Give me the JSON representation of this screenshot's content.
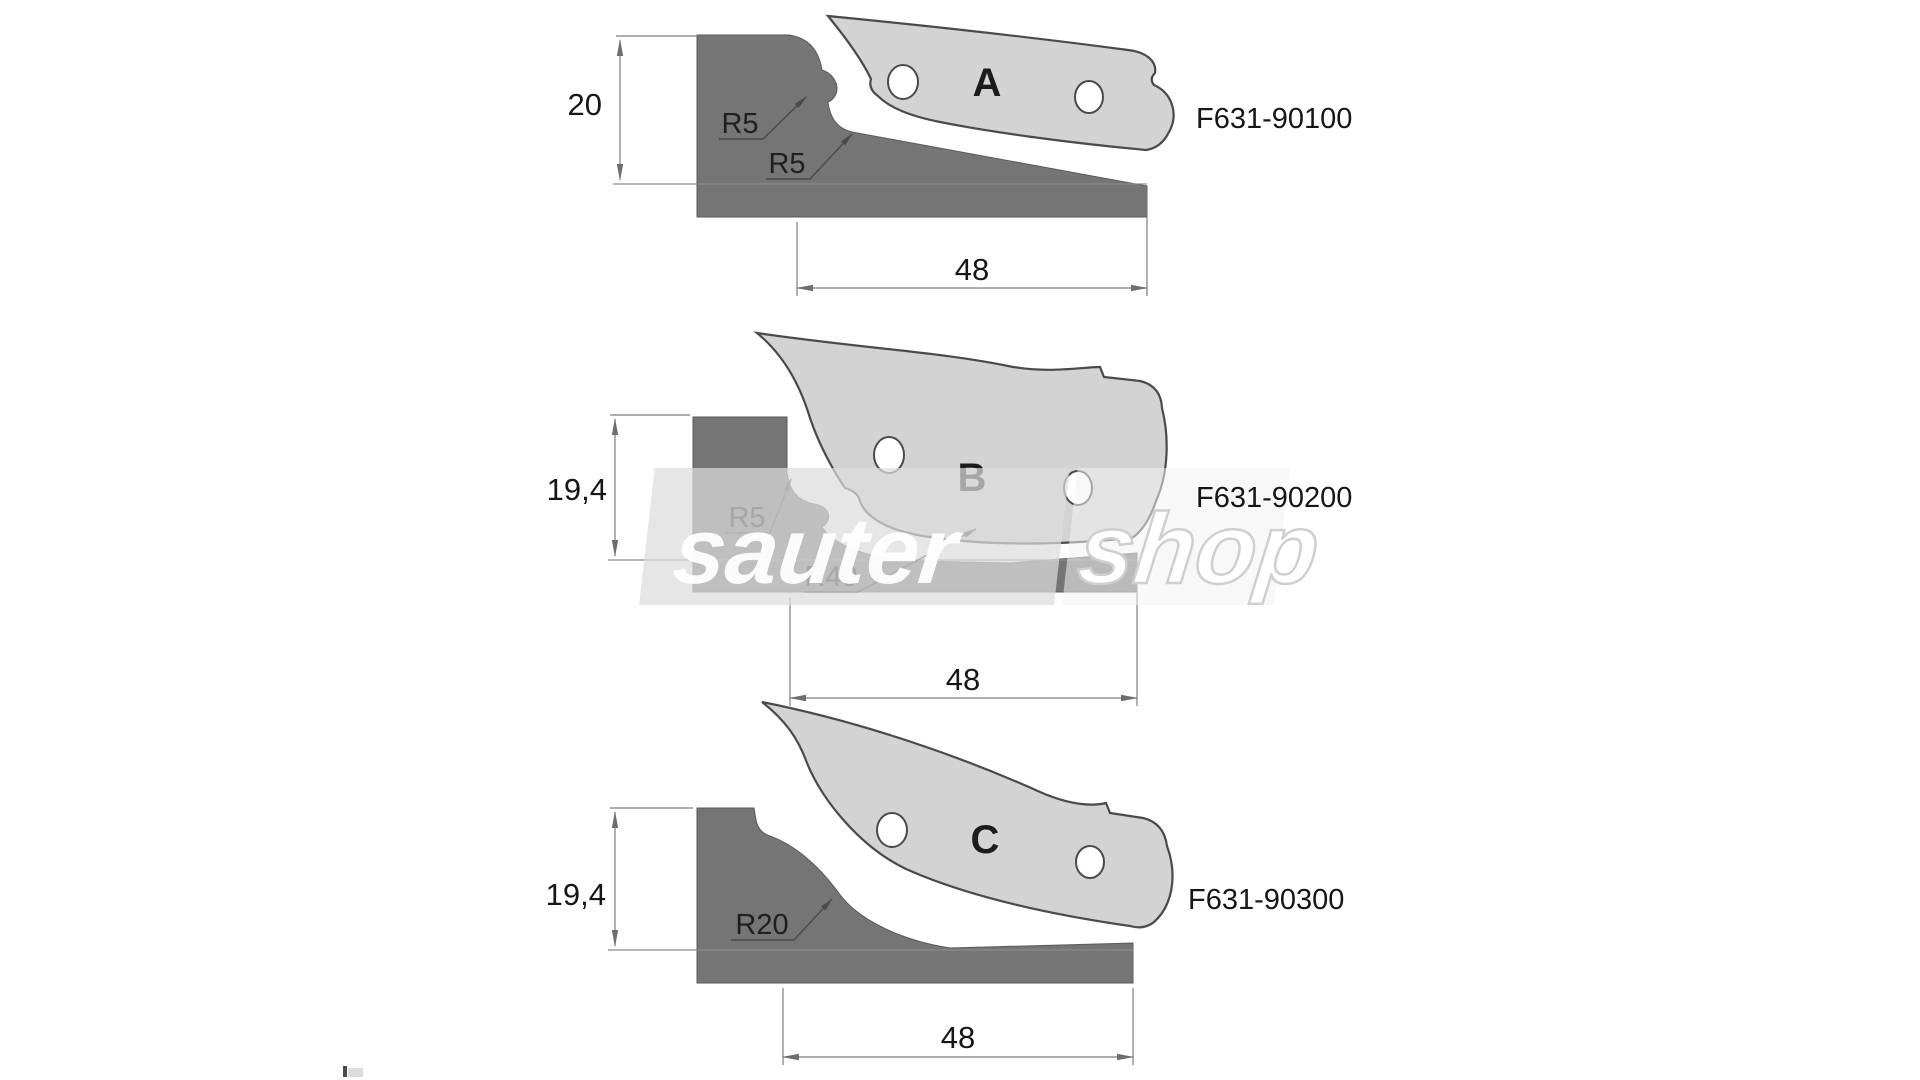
{
  "title": "Profile knife set technical drawing",
  "watermark": {
    "part1": "sauter",
    "part2": "shop"
  },
  "colors": {
    "workpiece": "#757575",
    "blade": "#d3d3d3",
    "outline": "#4a4a4a",
    "dim_line": "#7d7d7d",
    "text": "#161616",
    "watermark_band": "#dcdcdc"
  },
  "figures": [
    {
      "label": "A",
      "code": "F631-90100",
      "height_dim": "20",
      "width_dim": "48",
      "radii": [
        "R5",
        "R5"
      ]
    },
    {
      "label": "B",
      "code": "F631-90200",
      "height_dim": "19,4",
      "width_dim": "48",
      "radii": [
        "R5",
        "R40"
      ]
    },
    {
      "label": "C",
      "code": "F631-90300",
      "height_dim": "19,4",
      "width_dim": "48",
      "radii": [
        "R20"
      ]
    }
  ]
}
